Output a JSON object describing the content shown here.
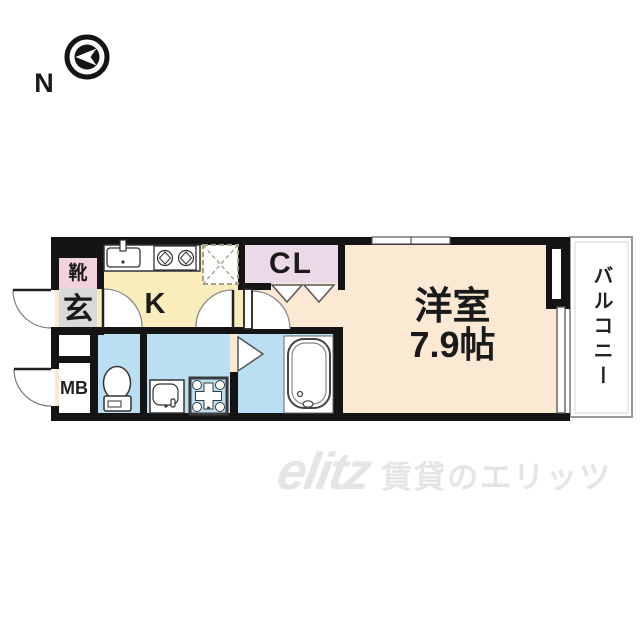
{
  "compass": {
    "label": "N"
  },
  "floorplan": {
    "labels": {
      "shoe_cabinet": "靴",
      "entrance": "玄",
      "meter_box": "MB",
      "kitchen": "K",
      "closet": "CL",
      "main_room_name": "洋室",
      "main_room_size": "7.9帖",
      "balcony": "バルコニー"
    },
    "colors": {
      "wall": "#141414",
      "kitchen_floor": "#f9edbb",
      "main_room_floor": "#fce9d4",
      "closet_floor": "#ecd9e8",
      "shoe_cabinet_floor": "#f3d2e0",
      "entrance_floor": "#d9d9d9",
      "wet_area_floor": "#badff2",
      "balcony_border": "#999999",
      "watermark": "#e5e5e5"
    }
  },
  "watermark": {
    "logo": "elitz",
    "text": "賃貸のエリッツ"
  }
}
